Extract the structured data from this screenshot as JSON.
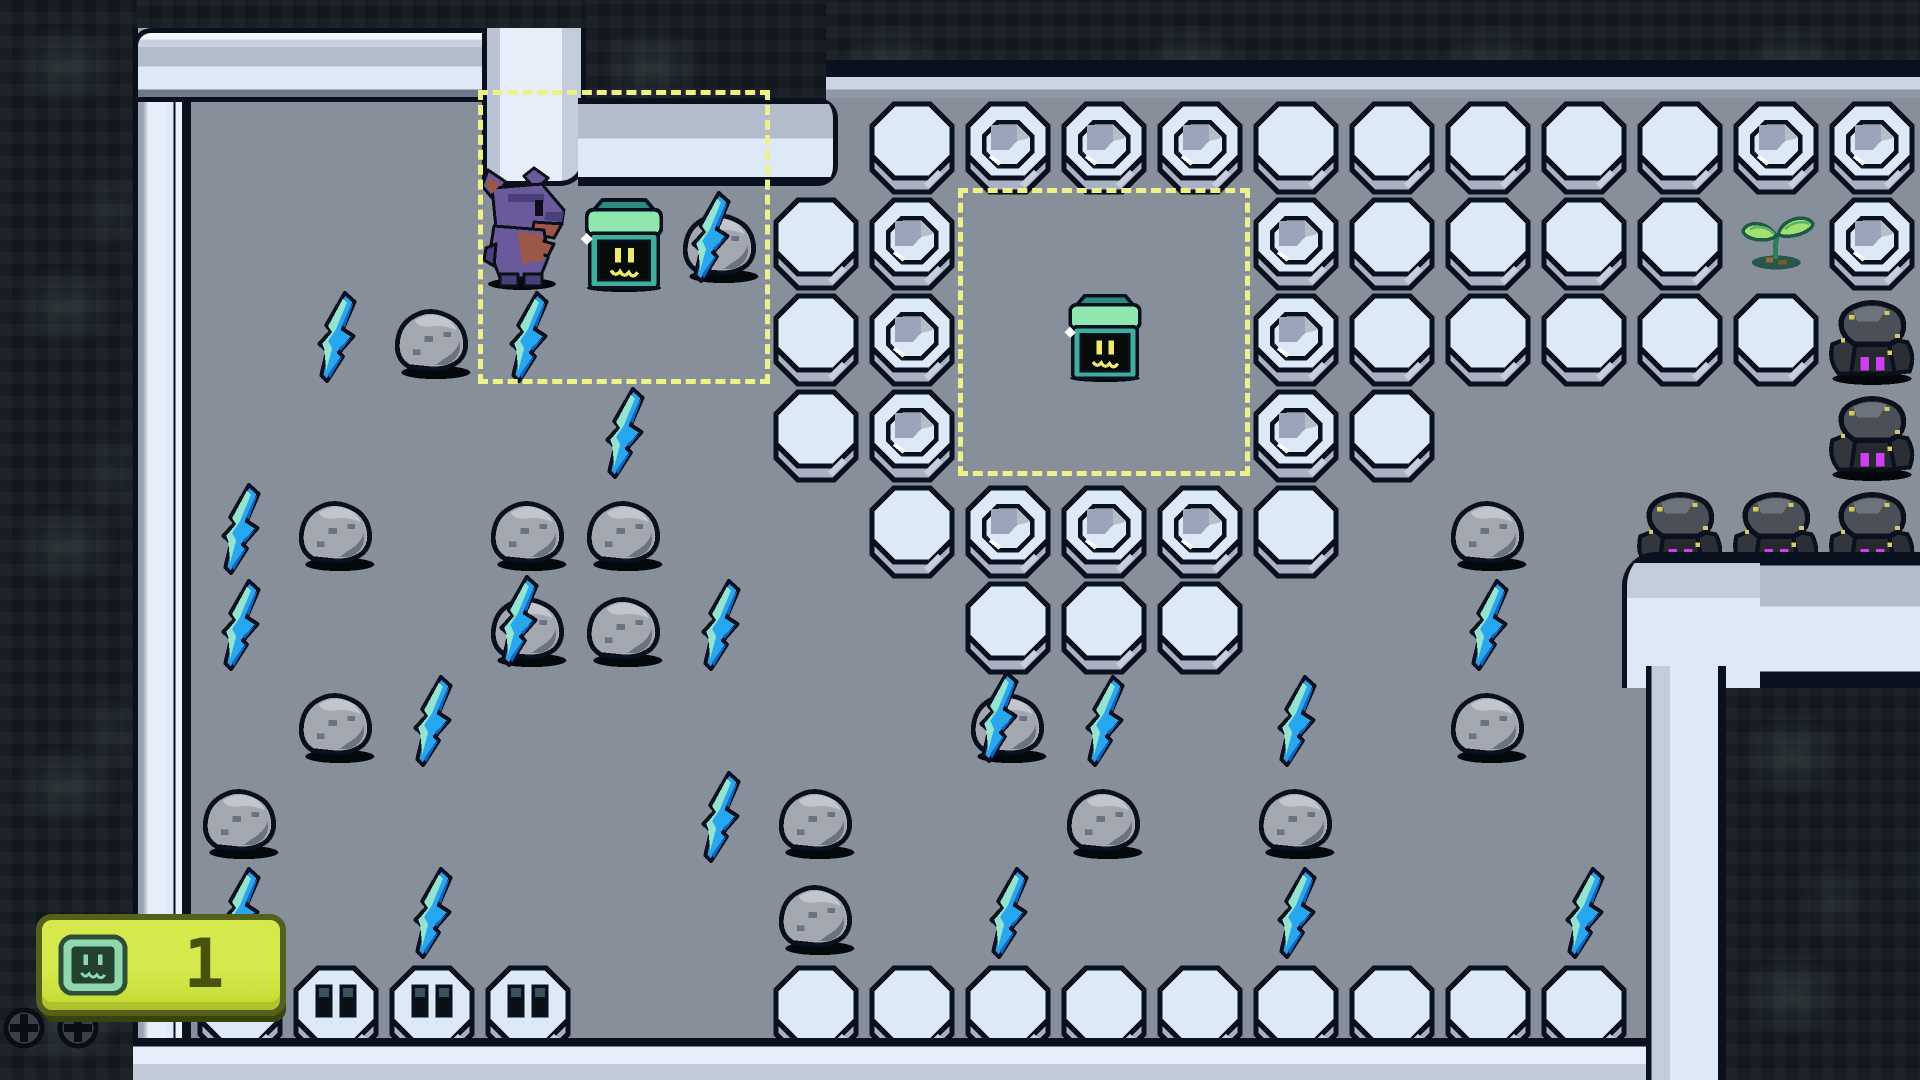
{
  "hud": {
    "item_count": "1",
    "item_icon": "terminal-chest-icon"
  },
  "grid": {
    "tile_size": 96,
    "cols": 20,
    "rows": 11
  },
  "palette": {
    "floor": "#878f9a",
    "cave": "#12171e",
    "tile_top": "#dce9f7",
    "tile_side": "#a9b2c4",
    "outline": "#0b101e",
    "wall_face": "#dde9f6",
    "wall_shade": "#b3bccb",
    "selection_dash": "#eef18a",
    "hud_badge": "#cbe13b",
    "hud_border": "#55611a",
    "hud_text": "#47520f",
    "bolt_blue": "#2aa6ef",
    "bolt_pale": "#93e5cf",
    "bolt_dark": "#1464c2",
    "spider_eyes": "#cf3ef2",
    "terminal_green": "#3fae9c",
    "terminal_mint": "#8fe6ae",
    "face_yellow": "#efe96e",
    "player_purple": "#6a5a9c",
    "player_brown": "#9b5747"
  },
  "map": {
    "plain_tiles": [
      [
        9,
        1
      ],
      [
        13,
        1
      ],
      [
        14,
        1
      ],
      [
        15,
        1
      ],
      [
        16,
        1
      ],
      [
        17,
        1
      ],
      [
        8,
        2
      ],
      [
        14,
        2
      ],
      [
        15,
        2
      ],
      [
        16,
        2
      ],
      [
        17,
        2
      ],
      [
        8,
        3
      ],
      [
        14,
        3
      ],
      [
        15,
        3
      ],
      [
        16,
        3
      ],
      [
        17,
        3
      ],
      [
        18,
        3
      ],
      [
        8,
        4
      ],
      [
        14,
        4
      ],
      [
        9,
        5
      ],
      [
        13,
        5
      ],
      [
        10,
        6
      ],
      [
        11,
        6
      ],
      [
        12,
        6
      ],
      [
        8,
        10
      ],
      [
        9,
        10
      ],
      [
        10,
        10
      ],
      [
        11,
        10
      ],
      [
        12,
        10
      ],
      [
        13,
        10
      ],
      [
        14,
        10
      ],
      [
        15,
        10
      ],
      [
        16,
        10
      ]
    ],
    "socket_tiles": [
      [
        10,
        1
      ],
      [
        11,
        1
      ],
      [
        12,
        1
      ],
      [
        18,
        1
      ],
      [
        19,
        1
      ],
      [
        9,
        2
      ],
      [
        13,
        2
      ],
      [
        19,
        2
      ],
      [
        9,
        3
      ],
      [
        13,
        3
      ],
      [
        9,
        4
      ],
      [
        13,
        4
      ],
      [
        10,
        5
      ],
      [
        11,
        5
      ],
      [
        12,
        5
      ]
    ],
    "slot_tiles": [
      [
        2,
        10
      ],
      [
        3,
        10
      ],
      [
        4,
        10
      ],
      [
        5,
        10
      ]
    ],
    "rocks": [
      [
        4,
        3
      ],
      [
        3,
        5
      ],
      [
        5,
        5
      ],
      [
        6,
        5
      ],
      [
        6,
        6
      ],
      [
        3,
        7
      ],
      [
        15,
        5
      ],
      [
        15,
        7
      ],
      [
        2,
        8
      ],
      [
        8,
        8
      ],
      [
        11,
        8
      ],
      [
        13,
        8
      ],
      [
        8,
        9
      ]
    ],
    "rocks_with_bolt": [
      [
        7,
        2
      ],
      [
        5,
        6
      ],
      [
        10,
        7
      ]
    ],
    "lightning": [
      [
        3,
        3
      ],
      [
        5,
        3
      ],
      [
        6,
        4
      ],
      [
        2,
        5
      ],
      [
        2,
        6
      ],
      [
        7,
        6
      ],
      [
        4,
        7
      ],
      [
        11,
        7
      ],
      [
        13,
        7
      ],
      [
        15,
        6
      ],
      [
        7,
        8
      ],
      [
        2,
        9
      ],
      [
        4,
        9
      ],
      [
        10,
        9
      ],
      [
        13,
        9
      ],
      [
        16,
        9
      ]
    ],
    "rock_spiders": [
      [
        19,
        3
      ],
      [
        19,
        4
      ],
      [
        17,
        5
      ],
      [
        18,
        5
      ],
      [
        19,
        5
      ]
    ],
    "sprouts": [
      [
        18,
        2
      ]
    ],
    "terminals": [
      {
        "col": 6,
        "row": 2,
        "size": "large"
      },
      {
        "col": 11,
        "row": 3,
        "size": "small"
      }
    ],
    "player": {
      "col": 5,
      "row": 2
    },
    "selection_boxes": [
      {
        "x": 478,
        "y": 90,
        "w": 292,
        "h": 294
      },
      {
        "x": 958,
        "y": 188,
        "w": 292,
        "h": 288
      }
    ],
    "screws": [
      {
        "x": 2,
        "y": 1006
      },
      {
        "x": 56,
        "y": 1006
      }
    ]
  },
  "walls": [
    {
      "kind": "left",
      "x": 133,
      "y": 28,
      "w": 58,
      "h": 1052
    },
    {
      "kind": "top",
      "x": 133,
      "y": 28,
      "w": 453,
      "h": 74
    },
    {
      "kind": "notch-vert",
      "x": 482,
      "y": 28,
      "w": 104,
      "h": 158
    },
    {
      "kind": "notch-horiz",
      "x": 578,
      "y": 98,
      "w": 260,
      "h": 88
    },
    {
      "kind": "band",
      "x": 826,
      "y": 60,
      "w": 1094,
      "h": 38
    },
    {
      "kind": "bottom",
      "x": 133,
      "y": 1038,
      "w": 1580,
      "h": 42
    },
    {
      "kind": "br-corner",
      "x": 1622,
      "y": 552,
      "w": 150,
      "h": 136
    },
    {
      "kind": "br-horiz",
      "x": 1760,
      "y": 552,
      "w": 160,
      "h": 136
    },
    {
      "kind": "br-vert",
      "x": 1646,
      "y": 666,
      "w": 80,
      "h": 414
    }
  ],
  "cave_regions": [
    {
      "x": 0,
      "y": 0,
      "w": 137,
      "h": 1080
    },
    {
      "x": 137,
      "y": 0,
      "w": 449,
      "h": 30
    },
    {
      "x": 586,
      "y": 0,
      "w": 240,
      "h": 100
    },
    {
      "x": 826,
      "y": 0,
      "w": 1094,
      "h": 62
    },
    {
      "x": 1726,
      "y": 688,
      "w": 194,
      "h": 392
    }
  ]
}
